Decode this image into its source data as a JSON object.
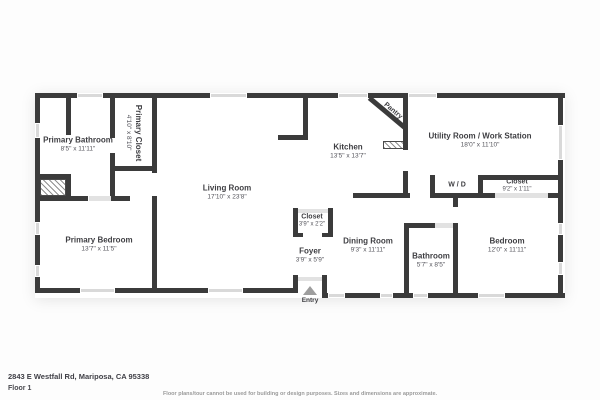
{
  "footer": {
    "address": "2843 E Westfall Rd, Mariposa, CA 95338",
    "floor_label": "Floor 1",
    "disclaimer": "Floor plans/tour cannot be used for building or design purposes. Sizes and dimensions are approximate."
  },
  "rooms": {
    "primary_bathroom": {
      "name": "Primary Bathroom",
      "dims": "8'5\" x 11'11\""
    },
    "primary_closet": {
      "name": "Primary Closet",
      "dims": "4'10\" x 8'10\""
    },
    "living_room": {
      "name": "Living Room",
      "dims": "17'10\" x 23'8\""
    },
    "kitchen": {
      "name": "Kitchen",
      "dims": "13'5\" x 13'7\""
    },
    "pantry": {
      "name": "Pantry"
    },
    "utility_room": {
      "name": "Utility Room / Work Station",
      "dims": "18'0\" x 11'10\""
    },
    "wd": {
      "name": "W / D"
    },
    "closet_right": {
      "name": "Closet",
      "dims": "9'2\" x 1'11\""
    },
    "primary_bedroom": {
      "name": "Primary Bedroom",
      "dims": "13'7\" x 11'5\""
    },
    "closet_foyer": {
      "name": "Closet",
      "dims": "3'9\" x 2'2\""
    },
    "foyer": {
      "name": "Foyer",
      "dims": "3'9\" x 5'9\""
    },
    "dining_room": {
      "name": "Dining Room",
      "dims": "9'3\" x 11'11\""
    },
    "bathroom": {
      "name": "Bathroom",
      "dims": "5'7\" x 8'5\""
    },
    "bedroom": {
      "name": "Bedroom",
      "dims": "12'0\" x 11'11\""
    },
    "entry": {
      "name": "Entry"
    }
  },
  "colors": {
    "wall": "#3b3b3b",
    "window": "#d9d9d9",
    "door": "#e2e2e2",
    "text": "#3e3e42",
    "entry_marker": "#9e9e9e"
  }
}
